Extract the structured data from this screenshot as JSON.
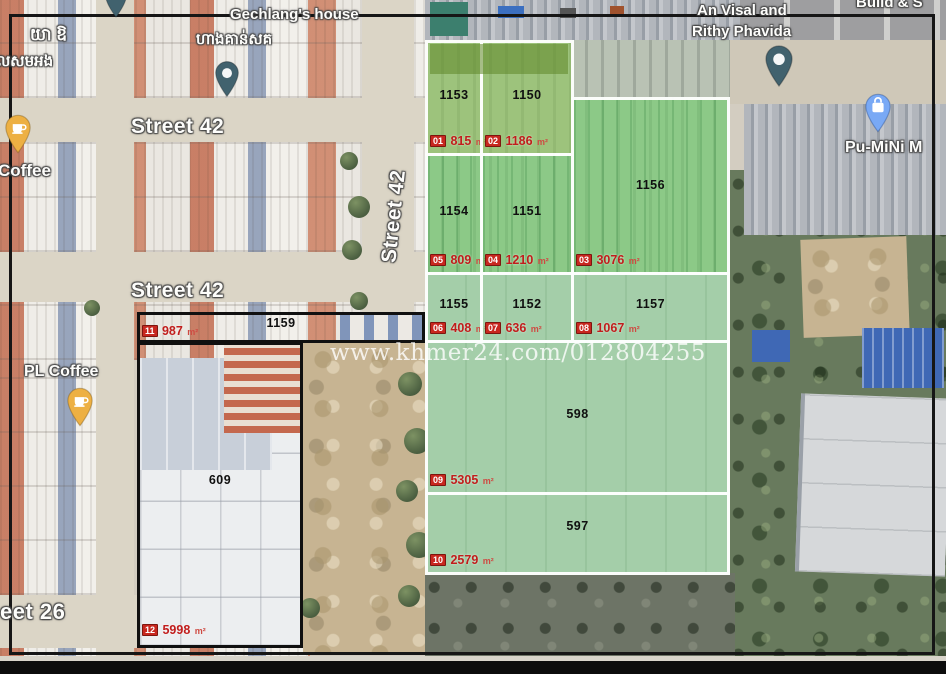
{
  "watermark": "www.khmer24.com/012804255",
  "unit": "m²",
  "streets": {
    "street42_top": "Street 42",
    "street42_mid": "Street 42",
    "street42_vertical": "Street 42",
    "street26_partial": "eet 26"
  },
  "places": {
    "gechlang_house": "Gechlang's house",
    "gechlang_house_khmer": "ហាងគាន់សគ",
    "khmer_topleft_1": "យា ឱ",
    "khmer_topleft_2": "លសមអង",
    "coffee": "Coffee",
    "pl_coffee": "PL Coffee",
    "an_visal_1": "An Visal and",
    "an_visal_2": "Rithy Phavida",
    "pu_mini": "Pu-MiNi M",
    "build_partial": "Build & S"
  },
  "parcels": [
    {
      "tag": "01",
      "number": "1153",
      "area": "815"
    },
    {
      "tag": "02",
      "number": "1150",
      "area": "1186"
    },
    {
      "tag": "03",
      "number": "1156",
      "area": "3076"
    },
    {
      "tag": "04",
      "number": "1151",
      "area": "1210"
    },
    {
      "tag": "05",
      "number": "1154",
      "area": "809"
    },
    {
      "tag": "06",
      "number": "1155",
      "area": "408"
    },
    {
      "tag": "07",
      "number": "1152",
      "area": "636"
    },
    {
      "tag": "08",
      "number": "1157",
      "area": "1067"
    },
    {
      "tag": "09",
      "number": "598",
      "area": "5305"
    },
    {
      "tag": "10",
      "number": "597",
      "area": "2579"
    },
    {
      "tag": "11",
      "number": "1159",
      "area": "987"
    },
    {
      "tag": "12",
      "number": "609",
      "area": "5998"
    }
  ],
  "colors": {
    "overlay_green": "#86d295",
    "area_red": "#c11d1c",
    "badge_red": "#c8271f",
    "box_black": "#101010"
  }
}
